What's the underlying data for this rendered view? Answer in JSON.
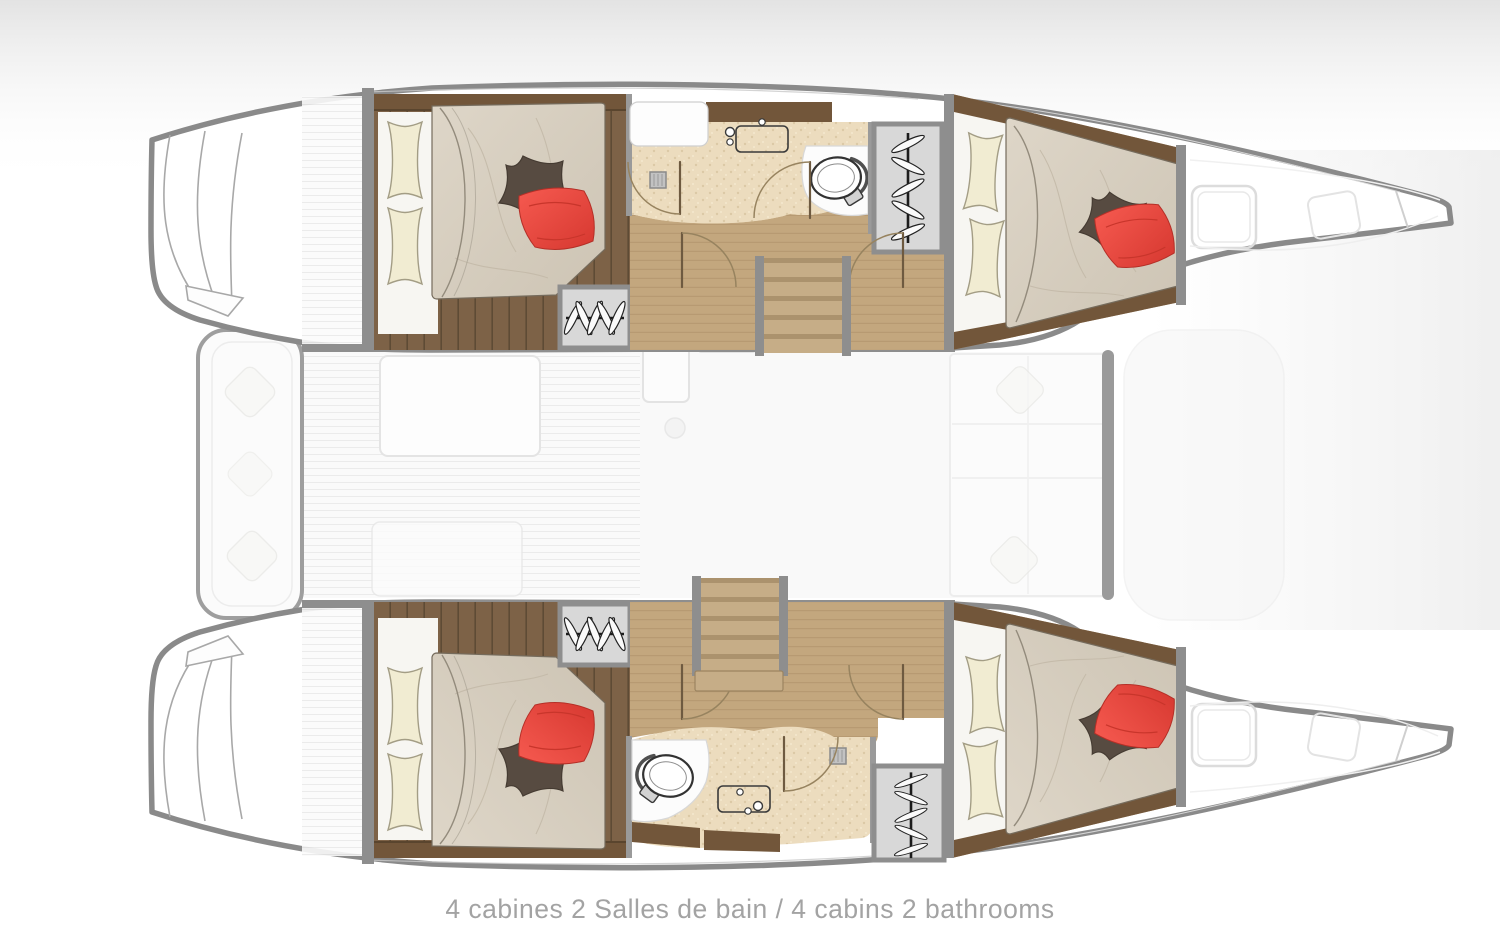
{
  "diagram": {
    "type": "catamaran-deck-plan",
    "caption": "4 cabines 2 Salles de bain / 4 cabins 2 bathrooms",
    "summary": {
      "cabins": 4,
      "bathrooms": 2
    },
    "colors": {
      "hull_outline": "#8a8a8a",
      "wall": "#8e8e8e",
      "wood_dark": "#72563a",
      "wood_floor": "#7d6247",
      "wood_light": "#c3a77e",
      "bathroom_floor": "#ecdcbe",
      "mattress": "#d8d0c2",
      "sheet": "#f7f6f2",
      "pillow_cream": "#f1ecd2",
      "pillow_red": "#ee4941",
      "pillow_dark": "#574b41",
      "wardrobe": "#d8d8d8",
      "stair_tread": "#c6ad87",
      "ghost_line": "#e6e6e6",
      "caption_text": "#a3a3a3"
    }
  }
}
